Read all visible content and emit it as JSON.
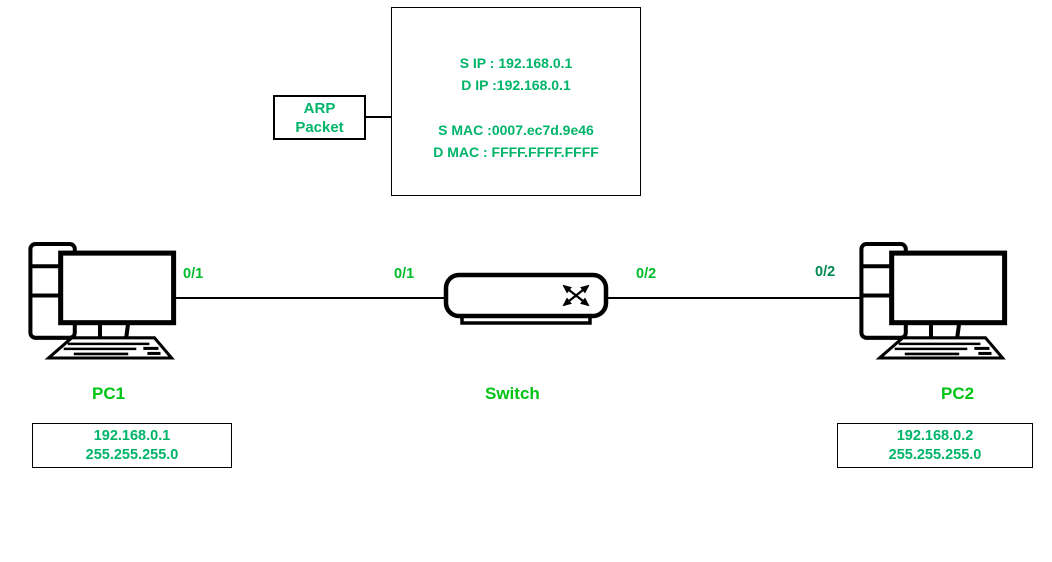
{
  "note": {
    "line_sip": "S IP : 192.168.0.1",
    "line_dip": "D IP :192.168.0.1",
    "line_smac": "S MAC :0007.ec7d.9e46",
    "line_dmac": "D MAC : FFFF.FFFF.FFFF"
  },
  "arp_label": {
    "line1": "ARP",
    "line2": "Packet"
  },
  "ports": {
    "pc1_side": "0/1",
    "switch_left": "0/1",
    "switch_right": "0/2",
    "pc2_side": "0/2"
  },
  "devices": {
    "pc1": {
      "name": "PC1",
      "ip": "192.168.0.1",
      "mask": "255.255.255.0"
    },
    "switch": {
      "name": "Switch"
    },
    "pc2": {
      "name": "PC2",
      "ip": "192.168.0.2",
      "mask": "255.255.255.0"
    }
  },
  "colors": {
    "note_green": "#00b468",
    "label_green": "#00c414",
    "port_green": "#00bc28",
    "port_green_dark": "#008850"
  }
}
